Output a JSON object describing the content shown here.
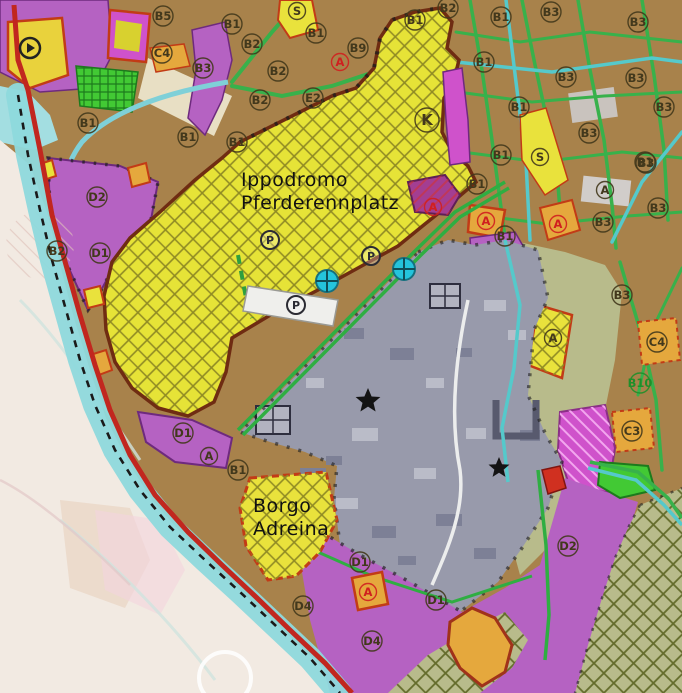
{
  "map": {
    "place_names": [
      {
        "id": "ippodromo",
        "lines": [
          "Ippodromo",
          "Pferderennplatz"
        ],
        "x": 241,
        "y": 186,
        "line_height": 23,
        "size": 19
      },
      {
        "id": "borgo",
        "lines": [
          "Borgo",
          "Adreina"
        ],
        "x": 253,
        "y": 512,
        "line_height": 23,
        "size": 19
      }
    ],
    "zone_labels": [
      {
        "t": "B5",
        "x": 163,
        "y": 16,
        "k": "dark"
      },
      {
        "t": "B1",
        "x": 232,
        "y": 24,
        "k": "dark"
      },
      {
        "t": "B2",
        "x": 252,
        "y": 44,
        "k": "dark"
      },
      {
        "t": "B3",
        "x": 203,
        "y": 68,
        "k": "dark"
      },
      {
        "t": "C4",
        "x": 162,
        "y": 53,
        "k": "dark"
      },
      {
        "t": "B1",
        "x": 88,
        "y": 123,
        "k": "dark"
      },
      {
        "t": "B1",
        "x": 188,
        "y": 137,
        "k": "dark"
      },
      {
        "t": "D2",
        "x": 97,
        "y": 197,
        "k": "dark"
      },
      {
        "t": "B2",
        "x": 57,
        "y": 251,
        "k": "dark"
      },
      {
        "t": "D1",
        "x": 100,
        "y": 253,
        "k": "dark"
      },
      {
        "t": "B1",
        "x": 237,
        "y": 142,
        "k": "dark"
      },
      {
        "t": "B2",
        "x": 278,
        "y": 71,
        "k": "dark"
      },
      {
        "t": "B2",
        "x": 260,
        "y": 100,
        "k": "dark"
      },
      {
        "t": "E2",
        "x": 313,
        "y": 98,
        "k": "dark"
      },
      {
        "t": "S",
        "x": 297,
        "y": 11,
        "k": "dark"
      },
      {
        "t": "B1",
        "x": 316,
        "y": 33,
        "k": "dark"
      },
      {
        "t": "B9",
        "x": 358,
        "y": 48,
        "k": "dark"
      },
      {
        "t": "A",
        "x": 340,
        "y": 62,
        "k": "red"
      },
      {
        "t": "B1",
        "x": 415,
        "y": 20,
        "k": "dark"
      },
      {
        "t": "B2",
        "x": 448,
        "y": 8,
        "k": "dark"
      },
      {
        "t": "K",
        "x": 427,
        "y": 120,
        "k": "dark",
        "big": true
      },
      {
        "t": "B1",
        "x": 501,
        "y": 17,
        "k": "dark"
      },
      {
        "t": "B3",
        "x": 551,
        "y": 12,
        "k": "dark"
      },
      {
        "t": "B3",
        "x": 638,
        "y": 22,
        "k": "dark"
      },
      {
        "t": "B1",
        "x": 484,
        "y": 62,
        "k": "dark"
      },
      {
        "t": "B3",
        "x": 566,
        "y": 77,
        "k": "dark"
      },
      {
        "t": "B3",
        "x": 636,
        "y": 78,
        "k": "dark"
      },
      {
        "t": "B1",
        "x": 519,
        "y": 107,
        "k": "dark"
      },
      {
        "t": "B3",
        "x": 664,
        "y": 107,
        "k": "dark"
      },
      {
        "t": "B3",
        "x": 589,
        "y": 133,
        "k": "dark"
      },
      {
        "t": "B1",
        "x": 645,
        "y": 162,
        "k": "dark"
      },
      {
        "t": "S",
        "x": 540,
        "y": 157,
        "k": "dark"
      },
      {
        "t": "B1",
        "x": 501,
        "y": 155,
        "k": "dark"
      },
      {
        "t": "B3",
        "x": 646,
        "y": 163,
        "k": "dark"
      },
      {
        "t": "B1",
        "x": 477,
        "y": 184,
        "k": "dark"
      },
      {
        "t": "A",
        "x": 433,
        "y": 207,
        "k": "red"
      },
      {
        "t": "A",
        "x": 486,
        "y": 221,
        "k": "red"
      },
      {
        "t": "B1",
        "x": 505,
        "y": 236,
        "k": "dark"
      },
      {
        "t": "A",
        "x": 605,
        "y": 190,
        "k": "dark"
      },
      {
        "t": "B3",
        "x": 658,
        "y": 208,
        "k": "dark"
      },
      {
        "t": "B3",
        "x": 603,
        "y": 222,
        "k": "dark"
      },
      {
        "t": "A",
        "x": 558,
        "y": 224,
        "k": "red"
      },
      {
        "t": "B3",
        "x": 622,
        "y": 295,
        "k": "dark"
      },
      {
        "t": "A",
        "x": 553,
        "y": 338,
        "k": "dark"
      },
      {
        "t": "C4",
        "x": 657,
        "y": 342,
        "k": "dark"
      },
      {
        "t": "B10",
        "x": 640,
        "y": 383,
        "k": "green"
      },
      {
        "t": "C3",
        "x": 632,
        "y": 431,
        "k": "dark"
      },
      {
        "t": "D1",
        "x": 183,
        "y": 433,
        "k": "dark"
      },
      {
        "t": "A",
        "x": 209,
        "y": 456,
        "k": "dark"
      },
      {
        "t": "B1",
        "x": 238,
        "y": 470,
        "k": "dark"
      },
      {
        "t": "D1",
        "x": 360,
        "y": 562,
        "k": "dark"
      },
      {
        "t": "A",
        "x": 368,
        "y": 592,
        "k": "red"
      },
      {
        "t": "D1",
        "x": 436,
        "y": 600,
        "k": "dark"
      },
      {
        "t": "D4",
        "x": 372,
        "y": 641,
        "k": "dark"
      },
      {
        "t": "D4",
        "x": 303,
        "y": 606,
        "k": "dark"
      },
      {
        "t": "D2",
        "x": 568,
        "y": 546,
        "k": "dark"
      }
    ],
    "icons": [
      {
        "type": "star",
        "x": 368,
        "y": 401,
        "s": 13
      },
      {
        "type": "star",
        "x": 499,
        "y": 468,
        "s": 11
      },
      {
        "type": "parking",
        "x": 270,
        "y": 240
      },
      {
        "type": "parking",
        "x": 371,
        "y": 256
      },
      {
        "type": "parking",
        "x": 296,
        "y": 305
      },
      {
        "type": "sports-field",
        "x": 327,
        "y": 281
      },
      {
        "type": "sports-field",
        "x": 404,
        "y": 269
      },
      {
        "type": "monument",
        "x": 30,
        "y": 48
      }
    ]
  },
  "colors": {
    "base_brown": "#a8824b",
    "street_green": "#38b14b",
    "street_teal": "#55c9cb",
    "ippodromo_yellow": "#e6e337",
    "ippodromo_border": "#6f2c12",
    "satellite_gray": "#989aab",
    "building_dark": "#7d8096",
    "building_light": "#babcc8",
    "zone_purple": "#b562c2",
    "purple_border": "#6e2a7e",
    "magenta_bright": "#cf52cb",
    "magenta_dark": "#a33e92",
    "olive_green": "#b8bb8b",
    "olive_hatch": "#646c2b",
    "orange_zone": "#e5a83d",
    "orange_border": "#c23b16",
    "parcel_green": "#42c934",
    "cream": "#e8dfc4",
    "faded_out": "#f2eae2",
    "water_band": "#8ed9dc",
    "road_red": "#c1271f",
    "icon_cyan": "#24c4dc",
    "label_dark": "#42381c",
    "label_red": "#d01f1f",
    "label_green": "#1f8f2a",
    "star_black": "#141414",
    "white_area": "#efefec"
  }
}
